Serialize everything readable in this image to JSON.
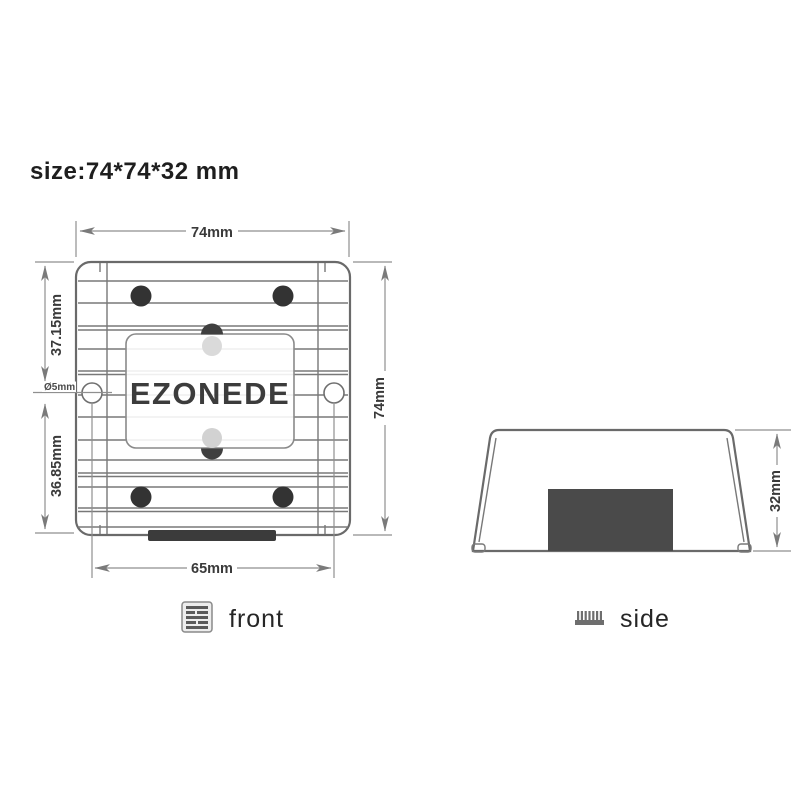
{
  "title": {
    "size_label": "size:74*74*32 mm"
  },
  "front_view": {
    "brand_text": "EZONEDE",
    "caption": "front",
    "icon": "heatsink-front-icon",
    "dimensions": {
      "width_top": "74mm",
      "height_right": "74mm",
      "upper_left": "37.15mm",
      "lower_left": "36.85mm",
      "hole_diameter": "Ø5mm",
      "mount_spacing_bottom": "65mm"
    }
  },
  "side_view": {
    "caption": "side",
    "icon": "heatsink-side-icon",
    "dimensions": {
      "height_right": "32mm"
    }
  },
  "colors": {
    "background": "#ffffff",
    "drawing_line": "#6a6a6a",
    "dimension_line": "#8f8f8f",
    "dark_fill": "#3b3b3b",
    "side_block_fill": "#4a4a4a",
    "text": "#2b2b2b"
  }
}
